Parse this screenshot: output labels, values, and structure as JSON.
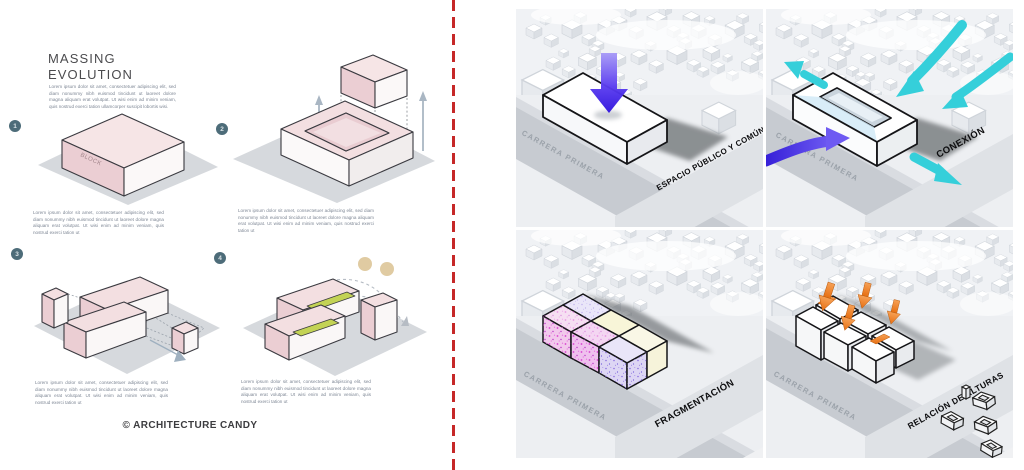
{
  "left_board": {
    "title": {
      "line1": "MASSING",
      "line2": "EVOLUTION"
    },
    "intro": "Lorem ipsum dolor sit amet, consectetuer adipiscing elit, sed diam nonummy nibh euismod tincidunt ut laoreet dolore magna aliquam erat volutpat. Ut wisi enim ad minim veniam, quis nostrud exerci tation ullamcorper suscipit lobortis wisi.",
    "steps": [
      {
        "number": "1",
        "block_label": "BLOCK",
        "caption": "Lorem ipsum dolor sit amet, consectetuer adipiscing elit, sed diam nonummy nibh euismod tincidunt ut laoreet dolore magna aliquam erat volutpat. Ut wisi enim ad minim veniam, quis nostrud exerci tation ut"
      },
      {
        "number": "2",
        "caption": "Lorem ipsum dolor sit amet, consectetuer adipiscing elit, sed diam nonummy nibh euismod tincidunt ut laoreet dolore magna aliquam erat volutpat. Ut wisi enim ad minim veniam, quis nostrud exerci tation ut"
      },
      {
        "number": "3",
        "caption": "Lorem ipsum dolor sit amet, consectetuer adipiscing elit, sed diam nonummy nibh euismod tincidunt ut laoreet dolore magna aliquam erat volutpat. Ut wisi enim ad minim veniam, quis nostrud exerci tation ut"
      },
      {
        "number": "4",
        "caption": "Lorem ipsum dolor sit amet, consectetuer adipiscing elit, sed diam nonummy nibh euismod tincidunt ut laoreet dolore magna aliquam erat volutpat. Ut wisi enim ad minim veniam, quis nostrud exerci tation ut"
      }
    ],
    "copyright": "© ARCHITECTURE CANDY"
  },
  "divider": {
    "style": "red-dashed-vertical",
    "color": "#c62828"
  },
  "right_board": {
    "quadrants": [
      {
        "label": "ESPACIO PÚBLICO Y COMÚN",
        "street": "CARRERA PRIMERA",
        "arrow": "purple-down-arrow"
      },
      {
        "label": "CONEXIÓN",
        "street": "CARRERA PRIMERA",
        "arrows": "cyan-flow-arrows-and-purple-entry-arrow"
      },
      {
        "label": "FRAGMENTACIÓN",
        "street": "CARRERA PRIMERA",
        "block_palette": [
          "#f2c9ec",
          "#f8f5d8",
          "#ddd6f4"
        ]
      },
      {
        "label": "RELACIÓN DE ALTURAS",
        "street": "CARRERA PRIMERA",
        "arrow": "orange-height-arrows"
      }
    ],
    "accent_colors": {
      "purple": "#4426e8",
      "cyan": "#35cfda",
      "orange": "#ef8030",
      "pink": "#ebced3",
      "divider_red": "#c62828"
    }
  }
}
